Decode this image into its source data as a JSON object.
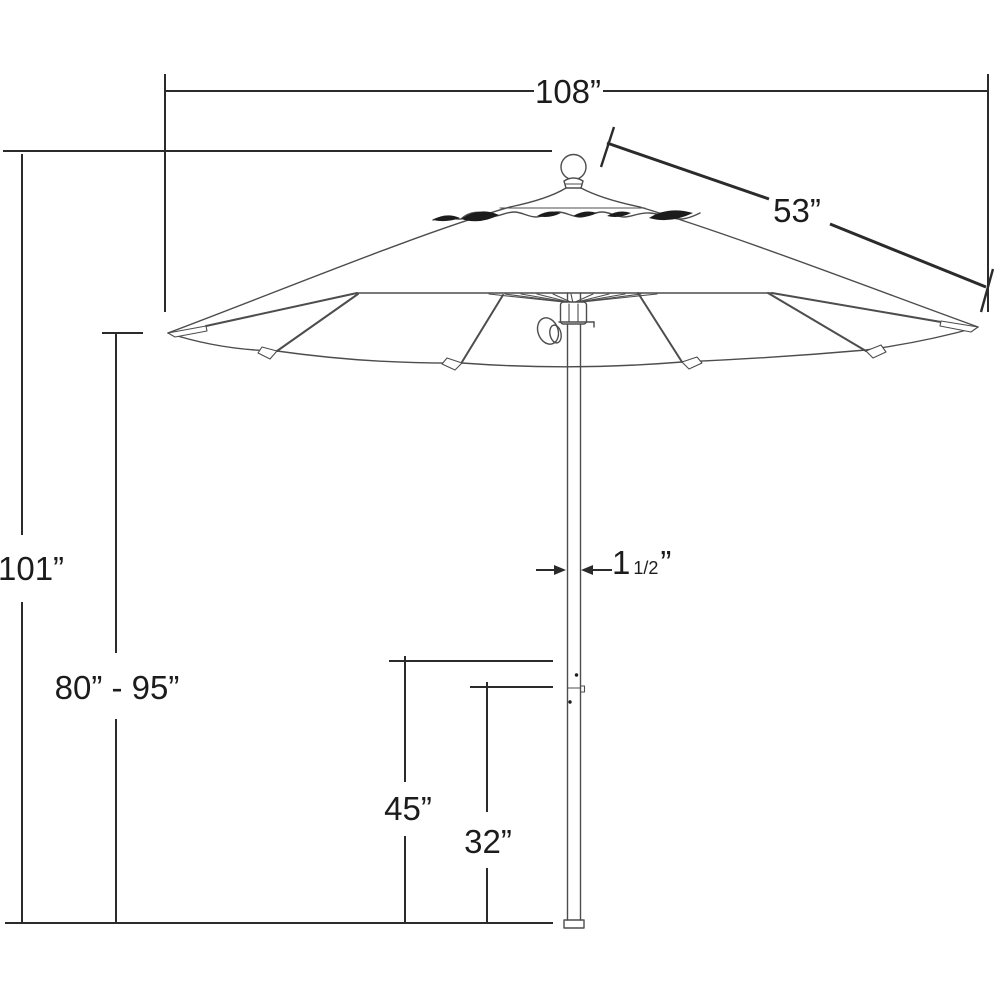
{
  "labels": {
    "canopy_width": "108”",
    "rib_length": "53”",
    "overall_height": "101”",
    "canopy_height_range": "80” - 95”",
    "lower_height": "45”",
    "base_height": "32”",
    "pole_diameter": {
      "whole": "1",
      "fraction": "1/2",
      "unit": "”"
    }
  },
  "colors": {
    "background": "#ffffff",
    "dimension_lines": "#2b2b2b",
    "artwork_lines": "#4d4d4d",
    "text": "#1c1c1c"
  }
}
